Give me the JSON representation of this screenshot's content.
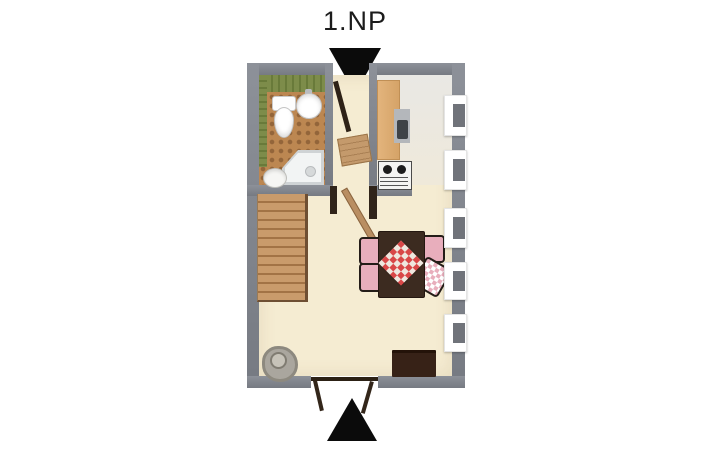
{
  "title": "1.NP",
  "icons": {
    "entrance_top": "triangle-down-icon",
    "entrance_bottom": "triangle-up-icon"
  },
  "colors": {
    "background": "#ffffff",
    "wall_gray": "#82868e",
    "floor_main_cream": "#f5ecd2",
    "floor_kitchen": "#e9e8e4",
    "floor_bathroom_terracotta": "#bc8751",
    "bathroom_wall_tiles_green": "#7d8c4a",
    "stairs_wood": "#c99b6b",
    "counter_wood": "#ddab72",
    "table_dark_wood": "#3c2b20",
    "tablecloth_red": "#d94848",
    "chair_cushion_pink": "#e8aebc",
    "window_pane_gray": "#70737a",
    "door_wood": "#c49a6c",
    "arrow_black": "#0b0b0b"
  },
  "plan": {
    "floor_label": "1.NP",
    "rooms": [
      {
        "name": "bathroom",
        "fixtures": [
          "toilet",
          "wash-basin",
          "shower-enclosure",
          "bidet"
        ]
      },
      {
        "name": "kitchen",
        "fixtures": [
          "counter",
          "kitchen-sink",
          "stove-cooktop"
        ]
      },
      {
        "name": "entry-hall",
        "fixtures": [
          "entrance-door",
          "interior-door"
        ]
      },
      {
        "name": "living-dining-room",
        "fixtures": [
          "staircase",
          "dining-table",
          "tablecloth",
          "chairs",
          "sideboard",
          "plant-pot",
          "french-doors"
        ]
      }
    ],
    "windows_count": 5,
    "stairs_steps": 12,
    "chairs_count": 4
  }
}
